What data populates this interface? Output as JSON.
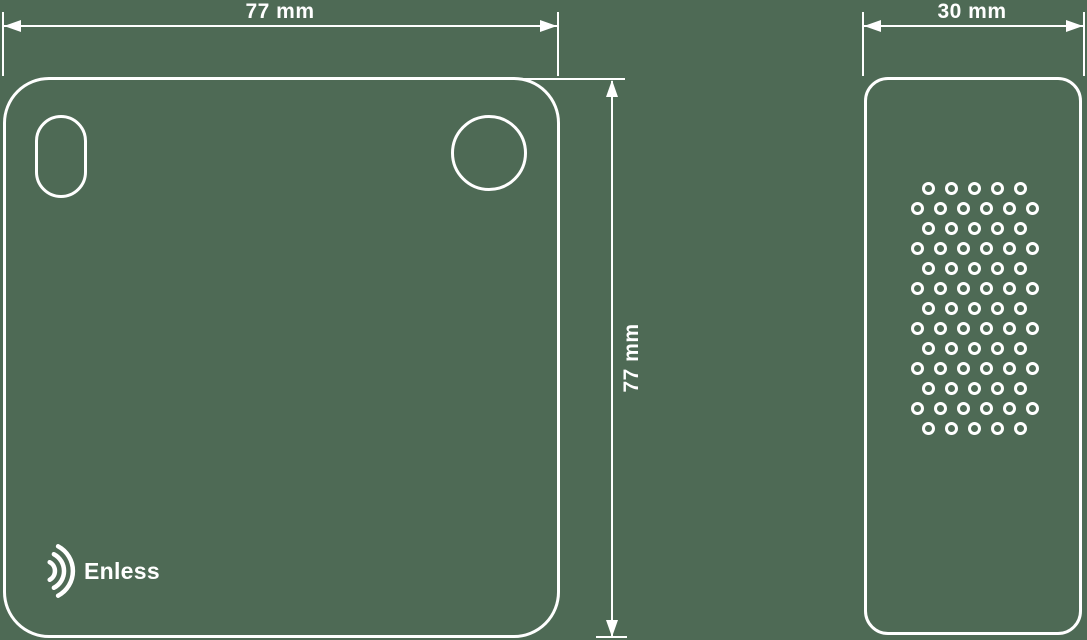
{
  "canvas": {
    "width": 1087,
    "height": 640,
    "background_color": "#4e6a55",
    "line_color": "#ffffff"
  },
  "drawing": {
    "type": "technical-dimension-drawing",
    "product_brand": "Enless",
    "views": {
      "front": {
        "name": "front-view",
        "width_dimension": {
          "label": "77 mm"
        },
        "height_dimension": {
          "label": "77 mm"
        },
        "features": [
          "oval-mounting-hole",
          "round-mounting-hole",
          "brand-logo"
        ]
      },
      "side": {
        "name": "side-view",
        "width_dimension": {
          "label": "30 mm"
        },
        "vent_holes": {
          "rows": 13,
          "row_pattern": [
            5,
            6,
            5,
            6,
            5,
            6,
            5,
            6,
            5,
            6,
            5,
            6,
            5
          ],
          "total_holes": 71,
          "start_y": 188,
          "row_spacing": 20,
          "x_start_rows_of_6": 917,
          "x_start_rows_of_5": 928,
          "col_spacing": 23,
          "hole_diameter": 13
        }
      }
    },
    "logo": {
      "icon": "signal-arcs-icon",
      "text": "Enless"
    }
  }
}
